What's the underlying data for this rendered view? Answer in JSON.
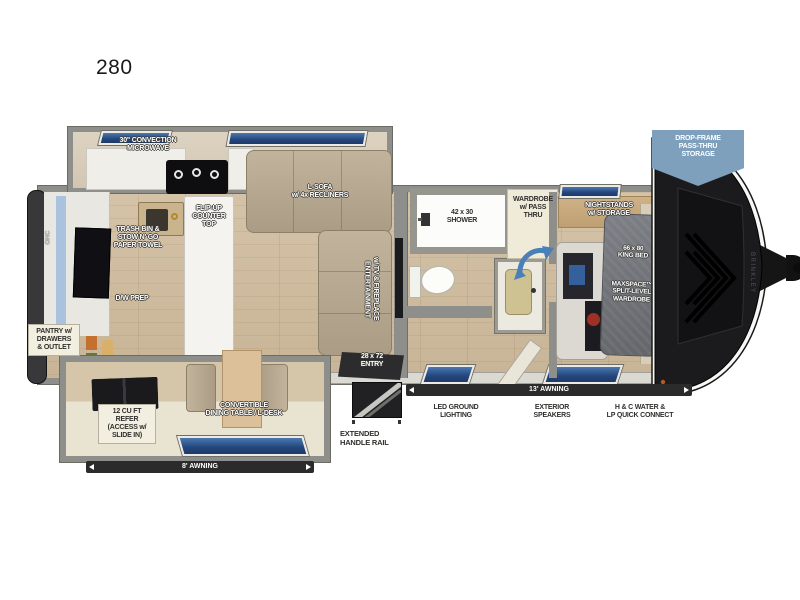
{
  "plan": {
    "model": "280",
    "brand": "BRINKLEY"
  },
  "badge": {
    "text": "DROP-FRAME\nPASS-THRU\nSTORAGE",
    "color": "#7ea0bd"
  },
  "labels": {
    "microwave": "30\" CONVECTION\nMICROWAVE",
    "sofa": "L-SOFA\nw/ 4x RECLINERS",
    "flip_counter": "FLIP-UP\nCOUNTER\nTOP",
    "trash": "TRASH BIN &\nSTOW N' GO\nPAPER TOWEL",
    "dw_prep": "D/W PREP",
    "entertainment": "ENTERTAINMENT\nw/ TV & FIREPLACE",
    "ohc": "OHC",
    "pantry": "PANTRY w/\nDRAWERS\n& OUTLET",
    "shower": "42 x 30\nSHOWER",
    "wardrobe": "WARDROBE\nw/ PASS\nTHRU",
    "nightstands": "NIGHTSTANDS\nw/ STORAGE",
    "king_bed": "66 x 80\nKING BED",
    "maxspace": "MAXSPACE™\nSPLIT-LEVEL\nWARDROBE",
    "refer": "12 CU FT\nREFER\n(ACCESS w/\nSLIDE IN)",
    "dining": "CONVERTIBLE\nDINING TABLE / L-DESK",
    "entry": "28 x 72\nENTRY",
    "handle_rail": "EXTENDED\nHANDLE RAIL",
    "led_lighting": "LED GROUND\nLIGHTING",
    "speakers": "EXTERIOR\nSPEAKERS",
    "water": "H & C WATER &\nLP QUICK CONNECT",
    "awning_13": "13' AWNING",
    "awning_8": "8' AWNING"
  },
  "colors": {
    "wall_gray": "#8e8e8a",
    "floor_wood": "#cdb99d",
    "window_blue": "#3c68a4",
    "awning_bar": "#2b2b2b",
    "sofa_beige": "#b3a48e",
    "bed_gray": "#72757b",
    "badge_blue": "#7ea0bd",
    "cap_black": "#1b1b1d"
  }
}
